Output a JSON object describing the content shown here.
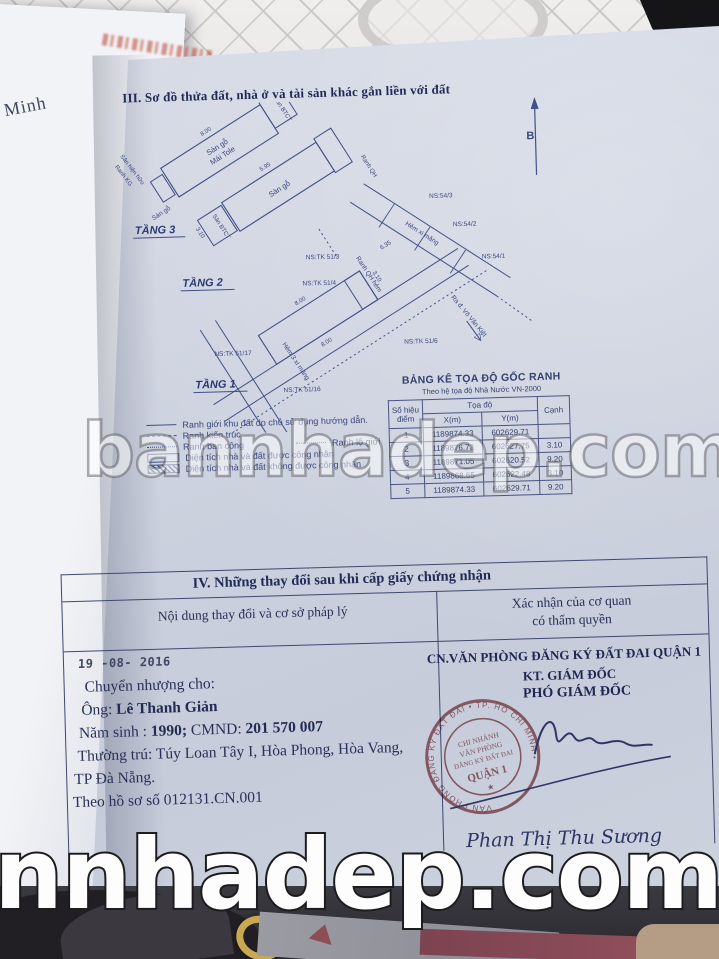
{
  "photo": {
    "watermark_middle": "bannhadep.com",
    "watermark_bottom": "nnhadep.com",
    "left_page_fragment": "í Minh"
  },
  "section3": {
    "heading": "III. Sơ đồ thửa đất, nhà ở và tài sản khác gắn liền với đất",
    "north_label": "B",
    "floor_labels": {
      "t3": "TẦNG 3",
      "t2": "TẦNG 2",
      "t1": "TẦNG 1"
    },
    "plans": {
      "san_go": "Sàn gỗ",
      "mai_tole": "Mái Tole",
      "san_btct": "Sàn BTCT",
      "san_go_small": "Sàn gỗ",
      "ranh_kg": "Ranh KG",
      "san_hien_huu": "Sân hiện hữu",
      "ranh_qh": "Ranh QH",
      "hem_xi_mang": "Hẻm xi măng",
      "hem_3_xi_mang": "Hẻm 3 xi măng",
      "ranh_qh_hem": "Ranh QH hẻm",
      "ra_duong": "Ra đ. Võ Văn Kiệt",
      "ns_54_3": "NS:54/3",
      "ns_54_2": "NS:54/2",
      "ns_54_1": "NS:54/1",
      "ns_tk_51_3": "NS:TK 51/3",
      "ns_tk_51_4": "NS:TK 51/4",
      "ns_tk_51_6": "NS:TK 51/6",
      "ns_tk_51_16": "NS:TK 51/16",
      "ns_tk_51_17": "NS:TK 51/17",
      "dims": {
        "d800a": "8.00",
        "d310a": "3.10",
        "d595": "5.95",
        "d310b": "3.10",
        "d800b": "8.00",
        "d800c": "8.00",
        "d310c": "3.10",
        "d635": "6.35"
      }
    },
    "legend": [
      {
        "label": "Ranh giới khu đất do chủ sử dụng hướng dẫn."
      },
      {
        "label": "Ranh kiến trúc"
      },
      {
        "label": "Ranh ban công",
        "label2": "Ranh lộ giới"
      },
      {
        "label": "Diện tích nhà và đất được công nhận"
      },
      {
        "label": "Diện tích nhà và đất không được công nhận"
      }
    ],
    "coord_table": {
      "title": "BẢNG KÊ TỌA ĐỘ GỐC RANH",
      "subtitle": "Theo hệ tọa độ Nhà Nước VN-2000",
      "col_point": "Số hiệu điểm",
      "col_coords": "Tọa độ",
      "col_x": "X(m)",
      "col_y": "Y(m)",
      "col_edge": "Cạnh",
      "rows": [
        {
          "p": "1",
          "x": "1189874.33",
          "y": "602629.71",
          "c": ""
        },
        {
          "p": "2",
          "x": "1189876.73",
          "y": "602627.75",
          "c": "3.10"
        },
        {
          "p": "3",
          "x": "1189871.05",
          "y": "602620.52",
          "c": "9.20"
        },
        {
          "p": "4",
          "x": "1189868.65",
          "y": "602622.48",
          "c": "3.10"
        },
        {
          "p": "5",
          "x": "1189874.33",
          "y": "602629.71",
          "c": "9.20"
        }
      ]
    }
  },
  "section4": {
    "heading": "IV. Những thay đổi sau khi cấp giấy chứng nhận",
    "col_left": "Nội dung thay đổi và cơ sở pháp lý",
    "col_right_line1": "Xác nhận của cơ quan",
    "col_right_line2": "có thẩm quyền",
    "date_stamp": "19 -08- 2016",
    "transfer": {
      "line1": "Chuyển nhượng cho:",
      "line2_label": "Ông:",
      "line2_name": "Lê Thanh Giản",
      "line3_label": "Năm sinh :",
      "line3_year": "1990;",
      "line3_cmnd_label": "CMND:",
      "line3_cmnd": "201 570 007",
      "line4": "Thường trú: Túy Loan Tây I, Hòa Phong, Hòa Vang,",
      "line5": "TP Đà Nẵng.",
      "line6": "Theo hồ sơ số 012131.CN.001"
    },
    "authority": {
      "office": "CN.VĂN PHÒNG ĐĂNG KÝ ĐẤT ĐAI QUẬN 1",
      "title1": "KT. GIÁM ĐỐC",
      "title2": "PHÓ GIÁM ĐỐC",
      "signer": "Phan Thị Thu Sương",
      "stamp": {
        "ring_text": "VĂN PHÒNG ĐĂNG KÝ ĐẤT ĐAI • TP. HỒ CHÍ MINH •",
        "line1": "CHI NHÁNH",
        "line2": "VĂN PHÒNG",
        "line3": "ĐĂNG KÝ ĐẤT ĐAI",
        "line4": "QUẬN 1",
        "star": "★"
      }
    }
  }
}
